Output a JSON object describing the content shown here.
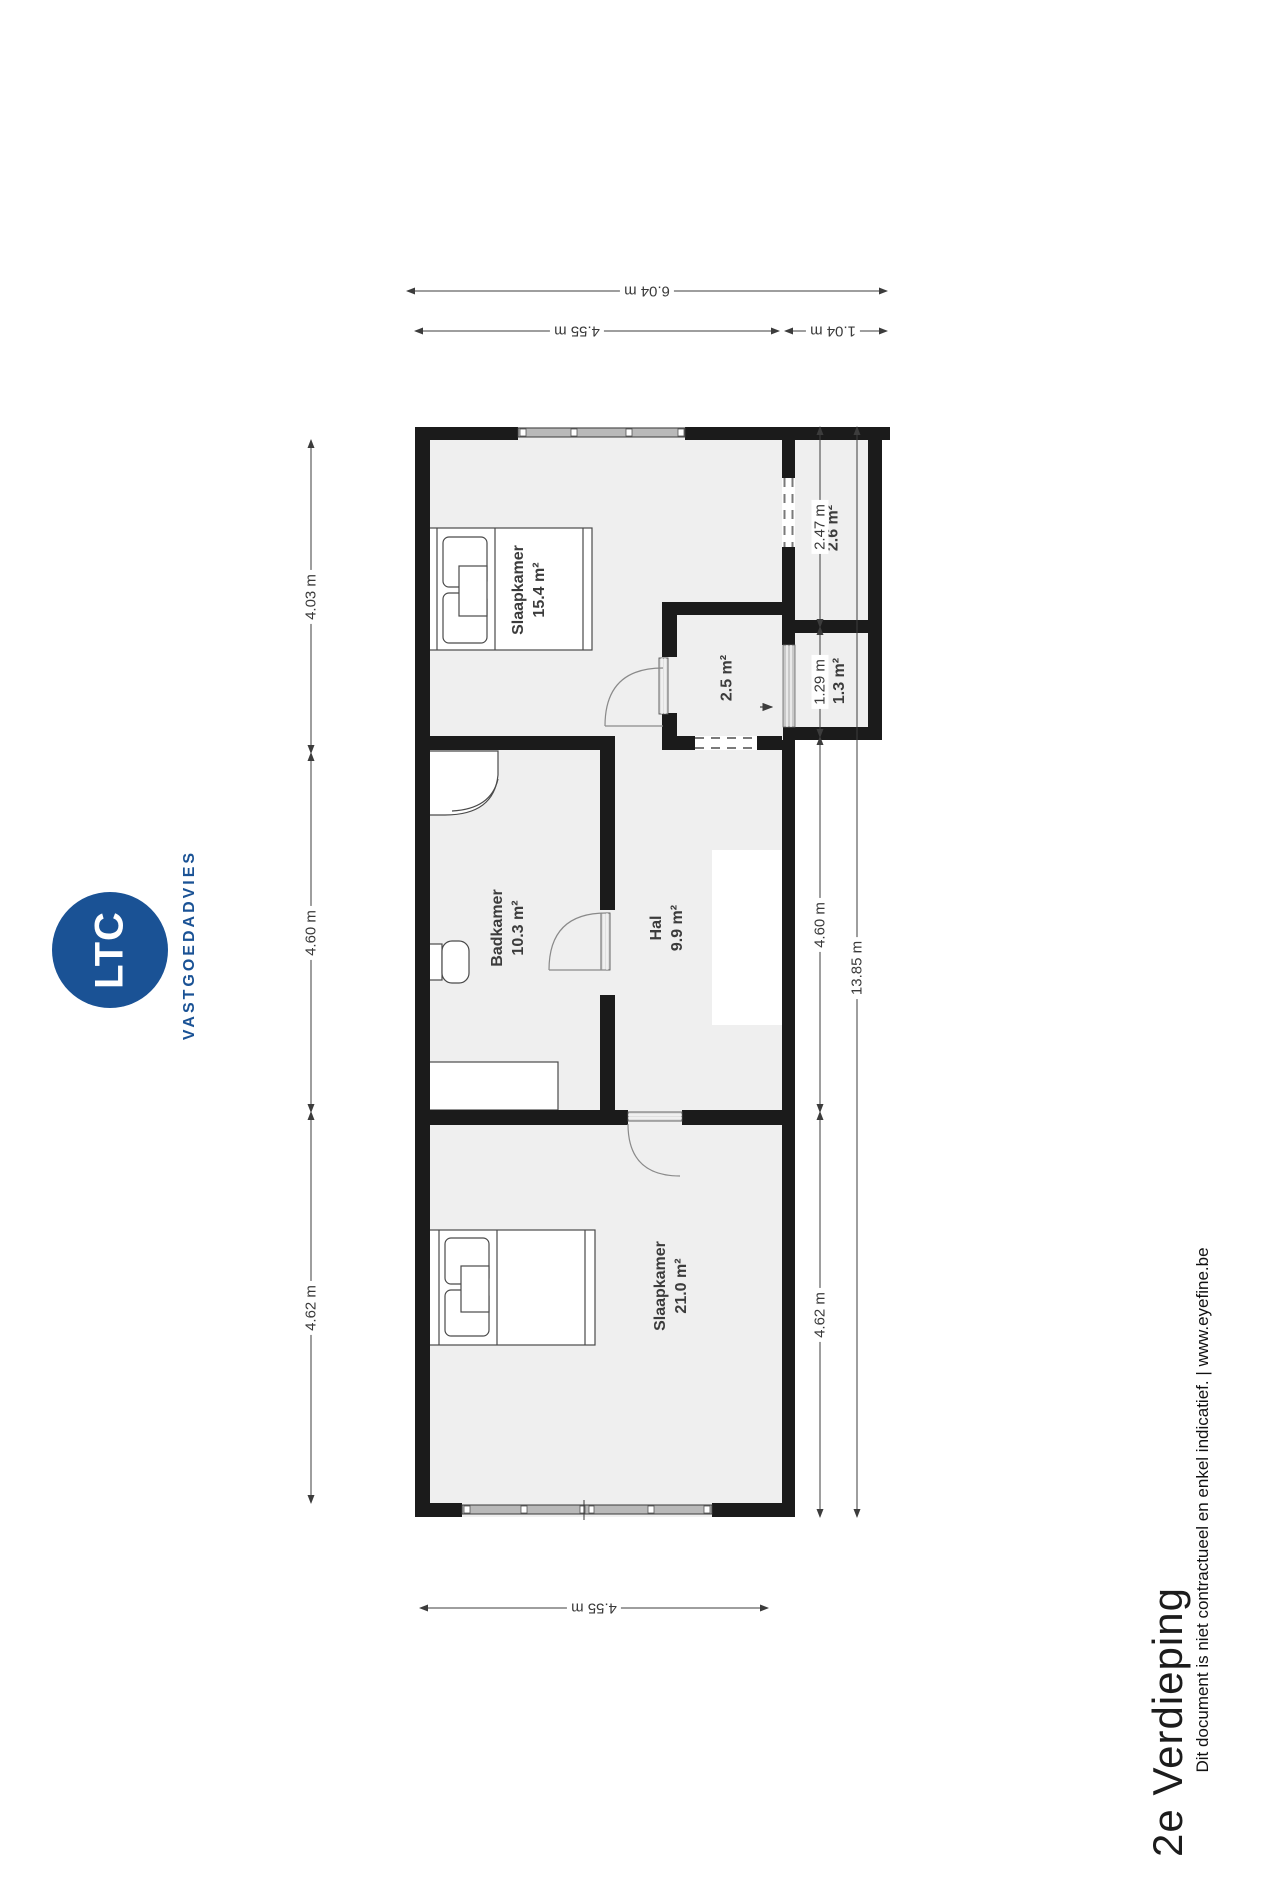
{
  "branding": {
    "logo_text": "LTC",
    "logo_subtext": "VASTGOEDADVIES",
    "brand_color": "#1a5295"
  },
  "title": "2e Verdieping",
  "disclaimer": "Dit document is niet contractueel en enkel indicatief. | www.eyefine.be",
  "rooms": {
    "slaapkamer1": {
      "name": "Slaapkamer",
      "area": "15.4 m²"
    },
    "berging": {
      "name": "",
      "area": "2.6 m²"
    },
    "kast": {
      "name": "",
      "area": "2.5 m²"
    },
    "lift": {
      "name": "Lift",
      "area": "1.3 m²"
    },
    "badkamer": {
      "name": "Badkamer",
      "area": "10.3 m²"
    },
    "hal": {
      "name": "Hal",
      "area": "9.9 m²"
    },
    "slaapkamer2": {
      "name": "Slaapkamer",
      "area": "21.0 m²"
    }
  },
  "dimensions": {
    "top_total": "6.04 m",
    "top_left": "4.55 m",
    "top_right": "1.04 m",
    "left_1": "4.03 m",
    "left_2": "4.60 m",
    "left_3": "4.62 m",
    "right_1": "2.47 m",
    "right_2": "1.29 m",
    "right_3": "4.60 m",
    "right_4": "4.62 m",
    "right_total": "13.85 m",
    "bottom": "4.55 m"
  }
}
